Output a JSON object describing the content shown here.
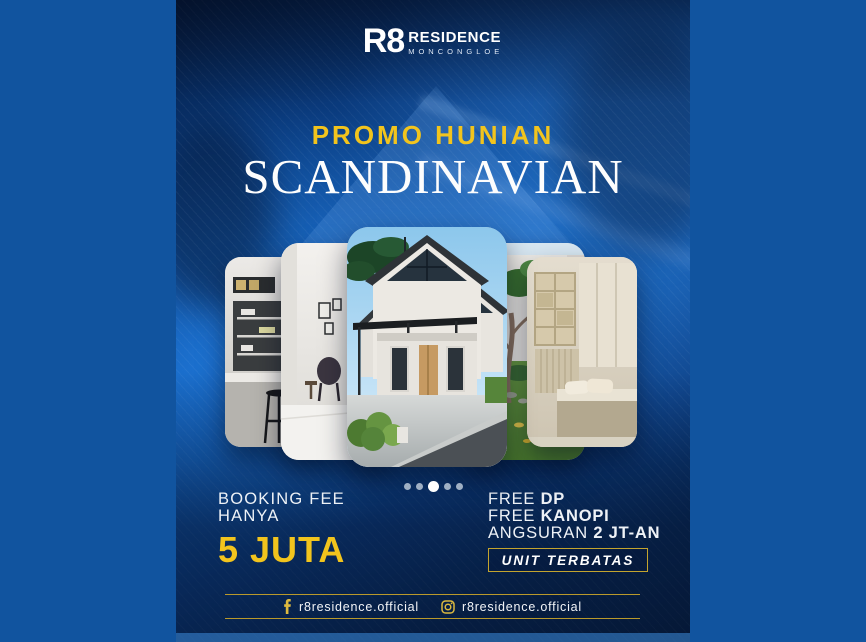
{
  "brand": {
    "mark": "R8",
    "name": "RESIDENCE",
    "location": "MONCONGLOE"
  },
  "hero": {
    "kicker": "PROMO HUNIAN",
    "title": "SCANDINAVIAN"
  },
  "carousel": {
    "slides": [
      {
        "name": "kitchen-interior"
      },
      {
        "name": "living-room-interior"
      },
      {
        "name": "house-exterior"
      },
      {
        "name": "courtyard-garden"
      },
      {
        "name": "bedroom-interior"
      }
    ],
    "dot_count": 5,
    "active_dot": 2
  },
  "offers": {
    "left": {
      "line1": "BOOKING FEE",
      "line2": "HANYA",
      "amount": "5 JUTA"
    },
    "right": {
      "rows": [
        {
          "normal": "FREE ",
          "bold": "DP"
        },
        {
          "normal": "FREE ",
          "bold": "KANOPI"
        },
        {
          "normal": "ANGSURAN ",
          "bold": "2 JT-AN"
        }
      ],
      "badge": "UNIT TERBATAS"
    }
  },
  "footer": {
    "facebook_handle": "r8residence.official",
    "instagram_handle": "r8residence.official"
  },
  "colors": {
    "accent_yellow": "#F2C41D",
    "gold_line": "#B9992B",
    "margin_blue": "#11549F",
    "poster_blue": "#1465C0",
    "navy": "#071F45"
  }
}
